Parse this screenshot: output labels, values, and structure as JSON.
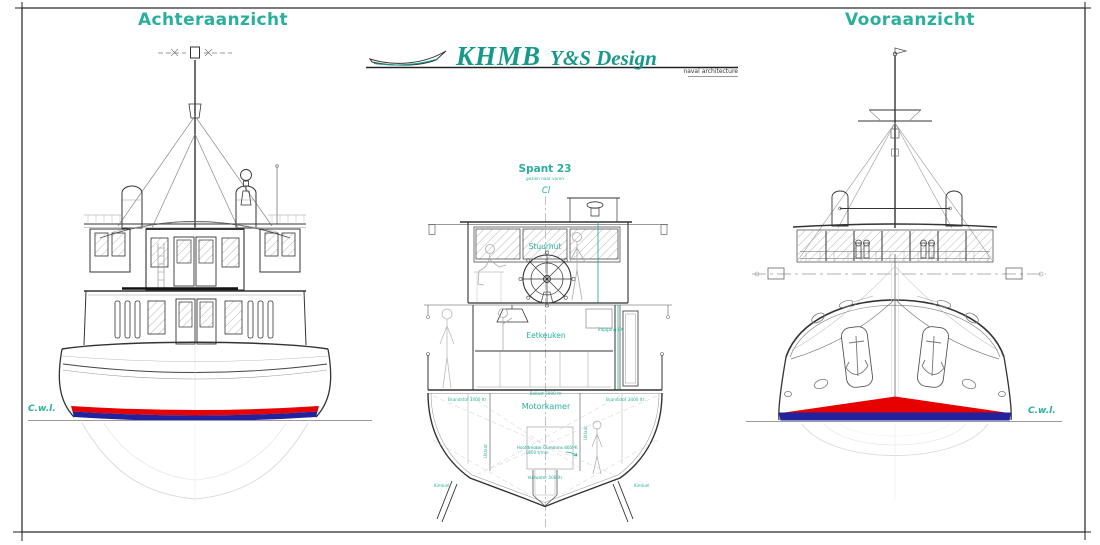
{
  "titles": {
    "stern": "Achteraanzicht",
    "bow": "Vooraanzicht"
  },
  "logo": {
    "company": "KHMB",
    "studio": "Y&S Design",
    "tagline": "naval architecture"
  },
  "section": {
    "title": "Spant 23",
    "subtitle": "gezien naar voren",
    "centerline": "Cl",
    "rooms": {
      "wheelhouse": "Stuurhut",
      "galley": "Eetkeuken",
      "stairs": "Trapgang BK",
      "engine": "Motorkamer"
    },
    "labels": {
      "tank_port": "Brandstof 3400 ltr",
      "tank_center": "Ballast 5000 ltr",
      "tank_starboard": "Brandstof 3400 ltr",
      "engine_note_1": "Hoofdmotor Cummins 405PK",
      "engine_note_2": "1800 t/min",
      "waste_tank": "Vuilwater 500 ltr",
      "bilge_keel_port": "Kimkiel",
      "bilge_keel_starboard": "Kimkiel",
      "exhaust_port": "Uitlaat",
      "exhaust_starboard": "Uitlaat"
    }
  },
  "waterline": {
    "left": "C.w.l.",
    "right": "C.w.l."
  },
  "colors": {
    "teal": "#2aaf9f",
    "logo_teal": "#16988a",
    "hull_red": "#e60000",
    "hull_blue": "#22229e"
  }
}
